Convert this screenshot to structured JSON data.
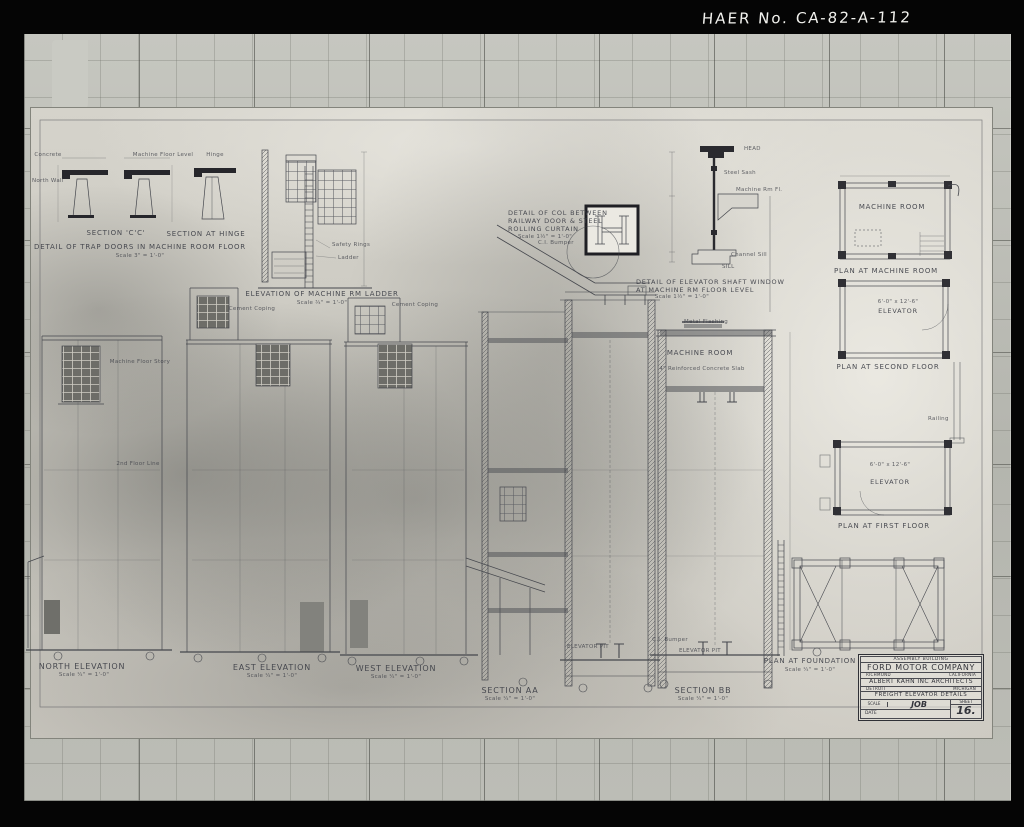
{
  "header": {
    "haer": "HAER No. CA-82-A-112"
  },
  "details": {
    "trap": {
      "cap_cc": "SECTION 'C'C'",
      "cap_hinge": "SECTION AT HINGE",
      "title": "DETAIL OF TRAP DOORS IN MACHINE ROOM FLOOR",
      "scale": "Scale 3\" = 1'-0\"",
      "note_concrete": "Concrete",
      "note_mfl": "Machine Floor Level",
      "note_hinge": "Hinge",
      "note_wall": "North Wall"
    },
    "ladder": {
      "title": "ELEVATION OF MACHINE RM LADDER",
      "scale": "Scale ¾\" = 1'-0\"",
      "note_rings": "Safety Rings",
      "note_ladder": "Ladder"
    },
    "column": {
      "t1": "DETAIL OF COL BETWEEN",
      "t2": "RAILWAY DOOR & STEEL",
      "t3": "ROLLING CURTAIN",
      "scale": "Scale 1½\" = 1'-0\"",
      "note_bumper": "C.I. Bumper"
    },
    "window": {
      "t1": "DETAIL OF ELEVATOR SHAFT WINDOW",
      "t2": "AT MACHINE RM FLOOR LEVEL",
      "scale": "Scale 1½\" = 1'-0\"",
      "head": "HEAD",
      "sill": "SILL",
      "note_sash": "Steel Sash",
      "note_mfl": "Machine Rm Fl.",
      "note_csill": "Channel Sill"
    }
  },
  "elevations": {
    "north": {
      "title": "NORTH ELEVATION",
      "scale": "Scale ¼\" = 1'-0\""
    },
    "east": {
      "title": "EAST ELEVATION",
      "scale": "Scale ¼\" = 1'-0\""
    },
    "west": {
      "title": "WEST ELEVATION",
      "scale": "Scale ¼\" = 1'-0\""
    },
    "note_coping_east": "Cement Coping",
    "note_coping_west": "Cement Coping",
    "note_mfs": "Machine Floor Story",
    "note_2fl": "2nd Floor Line"
  },
  "sections": {
    "aa": {
      "title": "SECTION AA",
      "scale": "Scale ¼\" = 1'-0\"",
      "pit": "ELEVATOR PIT"
    },
    "bb": {
      "title": "SECTION BB",
      "scale": "Scale ¼\" = 1'-0\"",
      "room": "MACHINE ROOM",
      "slab": "4\" Reinforced Concrete Slab",
      "flashing": "Metal Flashing",
      "pit": "ELEVATOR PIT",
      "bumper": "C.I. Bumper"
    }
  },
  "plans": {
    "machine": {
      "room": "MACHINE ROOM",
      "caption": "PLAN AT MACHINE ROOM"
    },
    "second": {
      "dim": "6'-0\" x 12'-6\"",
      "room": "ELEVATOR",
      "caption": "PLAN AT SECOND FLOOR"
    },
    "first": {
      "dim": "6'-0\" x 12'-6\"",
      "room": "ELEVATOR",
      "caption": "PLAN AT FIRST FLOOR",
      "note_railing": "Railing"
    },
    "foundation": {
      "caption": "PLAN AT FOUNDATION",
      "scale": "Scale ¼\" = 1'-0\""
    }
  },
  "titleblock": {
    "building": "ASSEMBLY BUILDING",
    "company": "FORD MOTOR COMPANY",
    "loc_left": "RICHMOND",
    "loc_right": "CALIFORNIA",
    "architect": "ALBERT KAHN INC ARCHITECTS",
    "arch_left": "DETROIT",
    "arch_right": "MICHIGAN",
    "sheet_title": "FREIGHT ELEVATOR DETAILS",
    "scale_label": "SCALE",
    "job": "JOB",
    "sheet": "SHEET",
    "date": "DATE",
    "number": "16."
  }
}
